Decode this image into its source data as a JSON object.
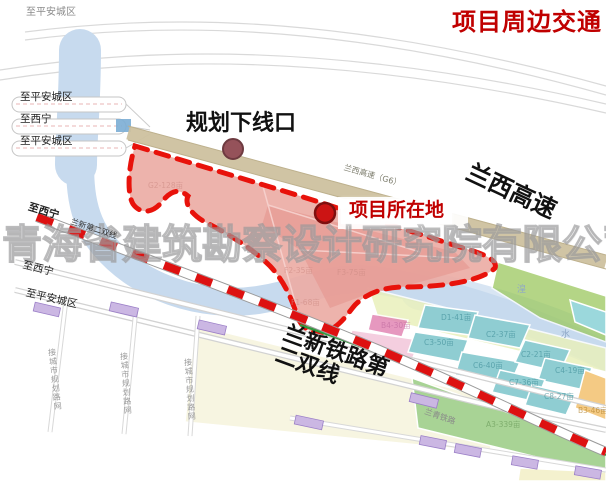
{
  "title": "项目周边交通",
  "colors": {
    "title_red": "#c00000",
    "boundary_red": "#e8120b",
    "project_pink": "#ecaca5",
    "corridor_tan": "#cec19f",
    "river_blue": "#c7daee",
    "teal_parcel": "#8fcdd2",
    "green_parcel": "#a8d395",
    "lavender": "#cbb7e3"
  },
  "callouts": {
    "planned_exit": "规划下线口",
    "project_location": "项目所在地",
    "expressway": "兰西高速",
    "railway_line1": "兰新铁路第",
    "railway_line2": "二双线"
  },
  "road_labels": {
    "top_left": "至平安城区",
    "left_1": "至平安城区",
    "left_2": "至西宁",
    "left_3": "至平安城区",
    "rail_dest": "至西宁",
    "rail_small": "兰新第二双线",
    "lower_road_1": "至西宁",
    "lower_road_2": "至平安城区",
    "expressway_small": "兰西高速（G6）",
    "old_railway": "兰青铁路",
    "vertical_road": "接城市规划路网",
    "river_char_1": "湟",
    "river_char_2": "水"
  },
  "watermark": "青海省建筑勘察设计研究院有限公司",
  "parcels": [
    {
      "label": "G2-128亩",
      "x": 148,
      "y": 180,
      "color": "#cf8d86"
    },
    {
      "label": "F2-35亩",
      "x": 284,
      "y": 265,
      "color": "#cf8d86"
    },
    {
      "label": "F3-75亩",
      "x": 337,
      "y": 267,
      "color": "#cf8d86"
    },
    {
      "label": "F1-68亩",
      "x": 291,
      "y": 297,
      "color": "#cf8d86"
    },
    {
      "label": "B4-30亩",
      "x": 381,
      "y": 320,
      "color": "#c06ba0"
    },
    {
      "label": "D1-41亩",
      "x": 441,
      "y": 312,
      "color": "#3f8e98"
    },
    {
      "label": "C3-50亩",
      "x": 424,
      "y": 337,
      "color": "#3f8e98"
    },
    {
      "label": "C2-37亩",
      "x": 486,
      "y": 329,
      "color": "#3f8e98"
    },
    {
      "label": "C6-40亩",
      "x": 473,
      "y": 360,
      "color": "#3f8e98"
    },
    {
      "label": "C2-21亩",
      "x": 521,
      "y": 349,
      "color": "#3f8e98"
    },
    {
      "label": "C4-19亩",
      "x": 555,
      "y": 365,
      "color": "#3f8e98"
    },
    {
      "label": "C7-36亩",
      "x": 509,
      "y": 377,
      "color": "#3f8e98"
    },
    {
      "label": "C8-27亩",
      "x": 544,
      "y": 391,
      "color": "#3f8e98"
    },
    {
      "label": "B3-46亩",
      "x": 578,
      "y": 405,
      "color": "#b07f28"
    },
    {
      "label": "A3-339亩",
      "x": 486,
      "y": 419,
      "color": "#699a58"
    }
  ]
}
